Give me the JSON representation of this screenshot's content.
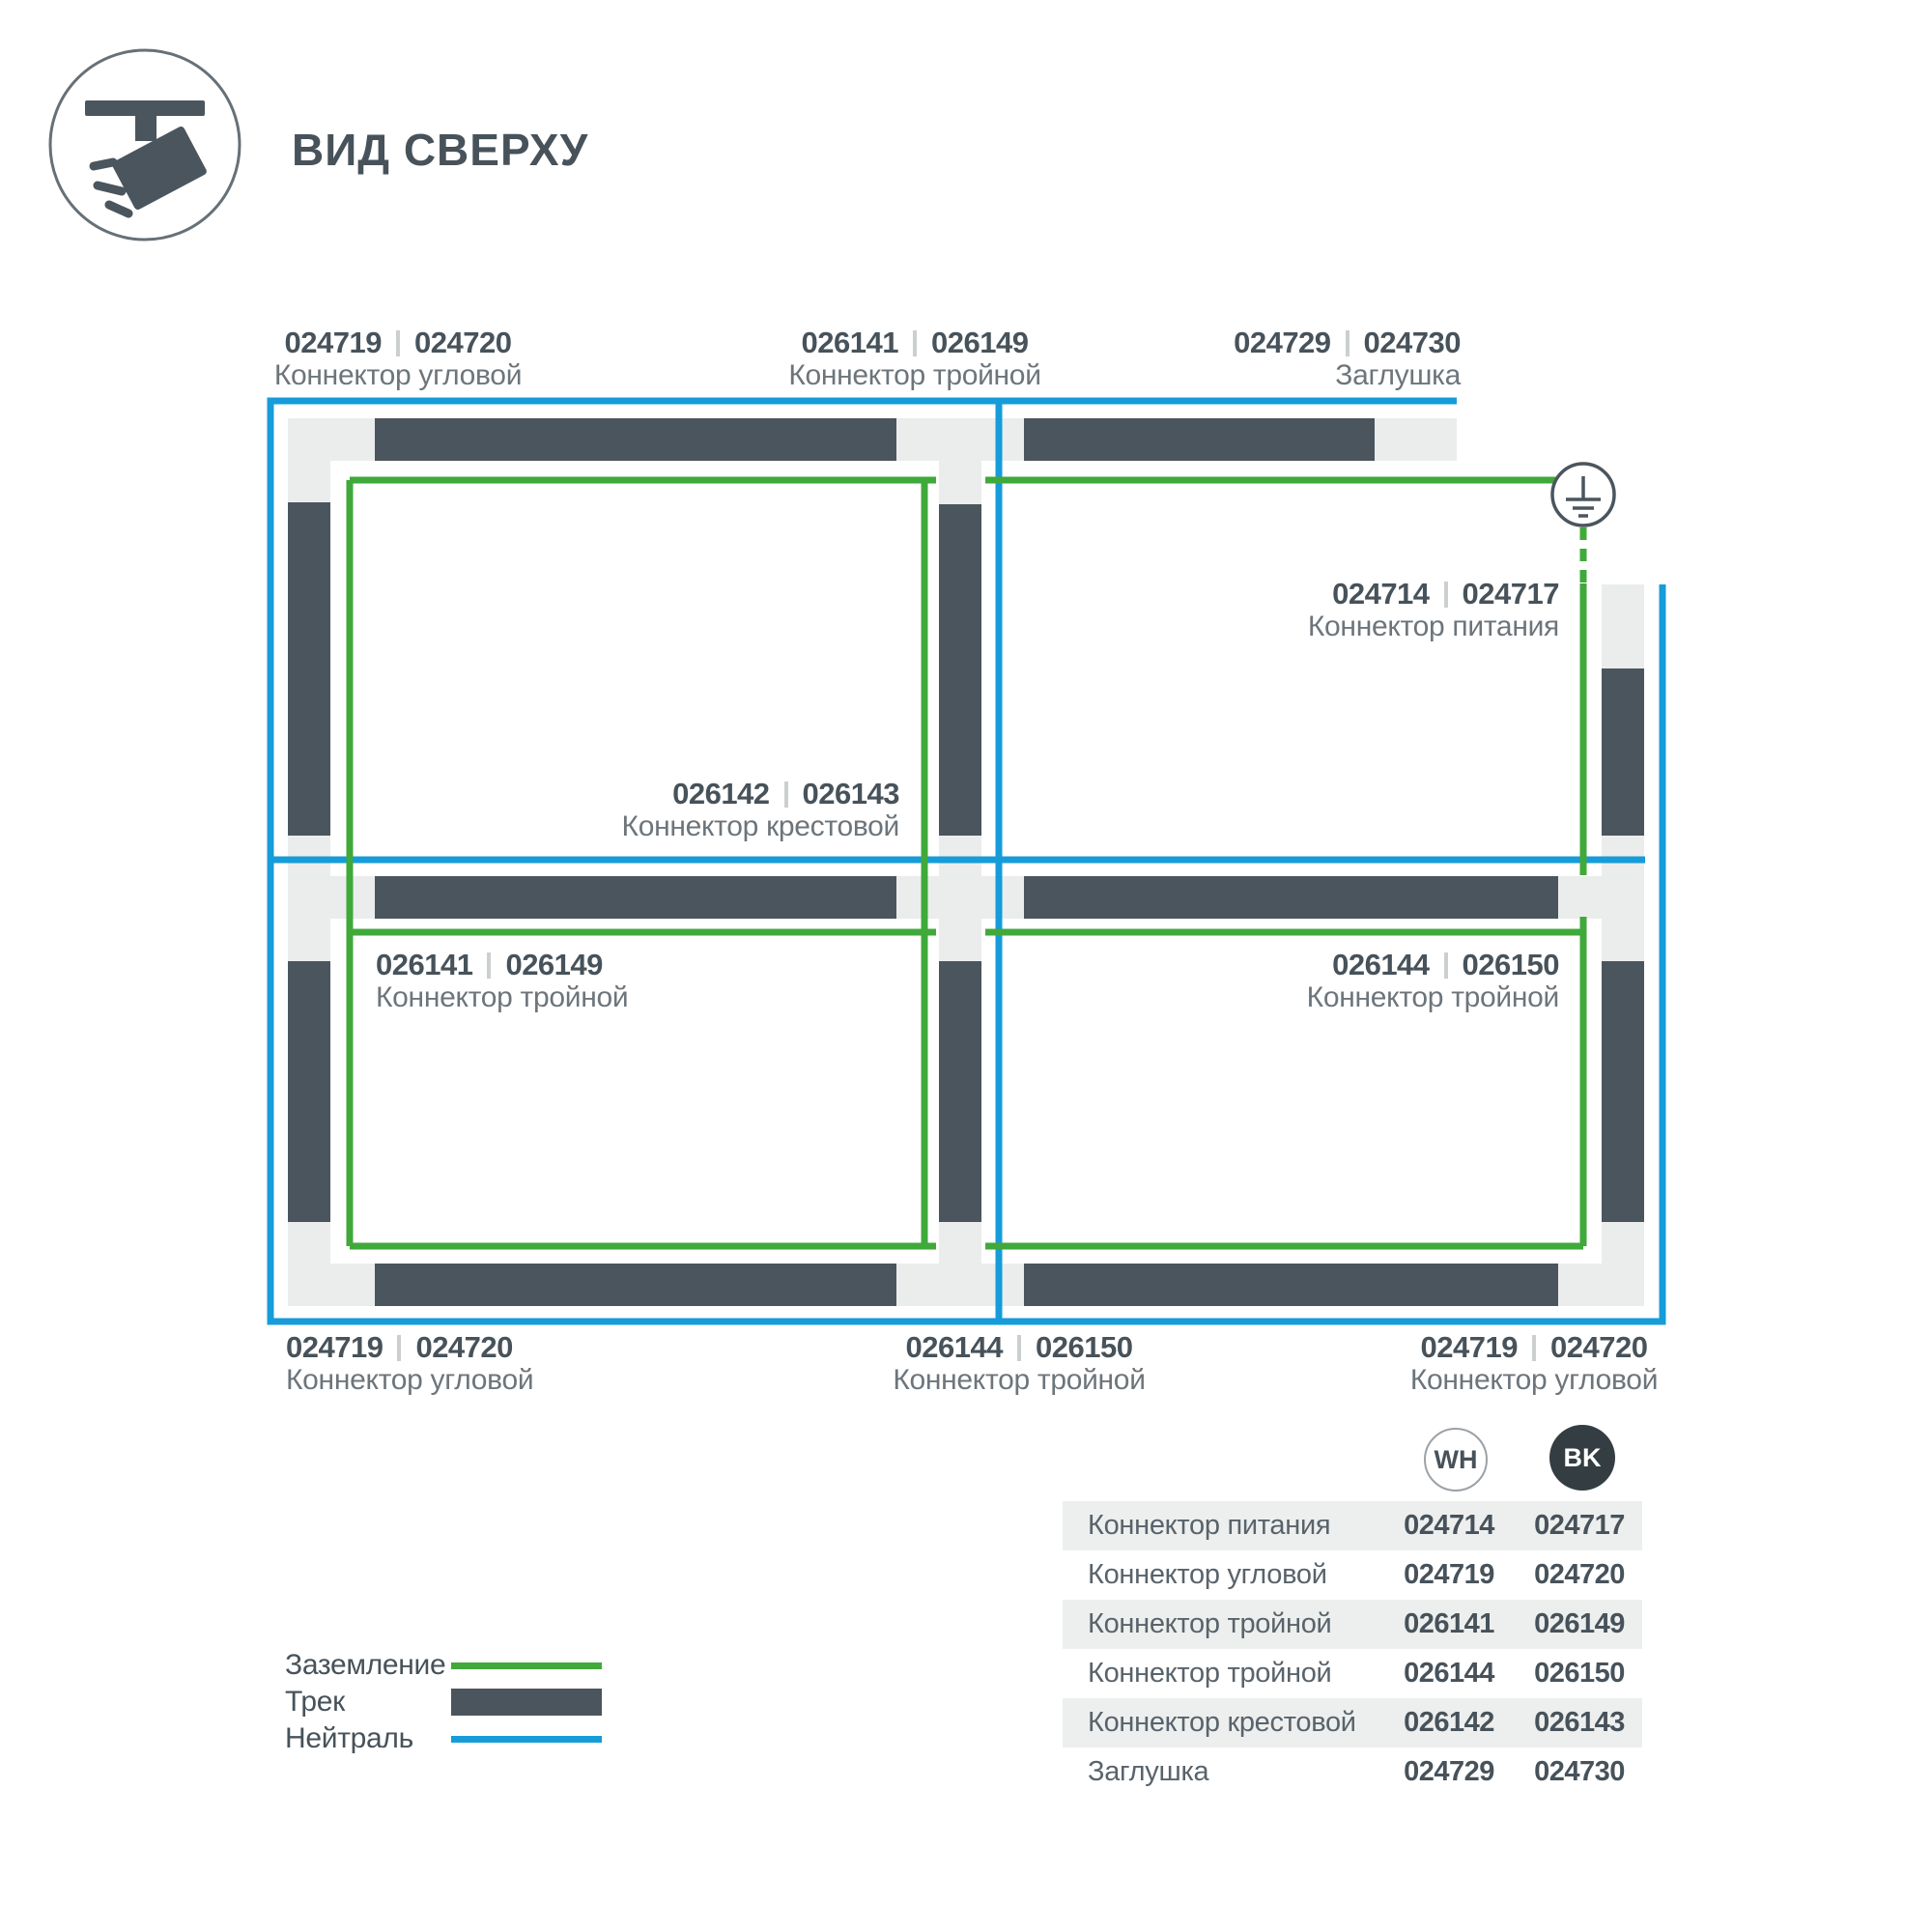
{
  "header": {
    "title": "ВИД СВЕРХУ",
    "icon": "track-spotlight-icon"
  },
  "diagram": {
    "ground_symbol": "earth-ground-icon",
    "labels": [
      {
        "codes": [
          "024719",
          "024720"
        ],
        "name": "Коннектор угловой"
      },
      {
        "codes": [
          "026141",
          "026149"
        ],
        "name": "Коннектор тройной"
      },
      {
        "codes": [
          "024729",
          "024730"
        ],
        "name": "Заглушка"
      },
      {
        "codes": [
          "024714",
          "024717"
        ],
        "name": "Коннектор питания"
      },
      {
        "codes": [
          "026142",
          "026143"
        ],
        "name": "Коннектор крестовой"
      },
      {
        "codes": [
          "026141",
          "026149"
        ],
        "name": "Коннектор тройной"
      },
      {
        "codes": [
          "026144",
          "026150"
        ],
        "name": "Коннектор тройной"
      },
      {
        "codes": [
          "024719",
          "024720"
        ],
        "name": "Коннектор угловой"
      },
      {
        "codes": [
          "026144",
          "026150"
        ],
        "name": "Коннектор тройной"
      },
      {
        "codes": [
          "024719",
          "024720"
        ],
        "name": "Коннектор угловой"
      }
    ]
  },
  "legend": {
    "items": [
      {
        "label": "Заземление",
        "swatch": "green-line"
      },
      {
        "label": "Трек",
        "swatch": "track-bar"
      },
      {
        "label": "Нейтраль",
        "swatch": "blue-line"
      }
    ]
  },
  "table": {
    "columns": [
      {
        "code": "WH"
      },
      {
        "code": "BK"
      }
    ],
    "rows": [
      {
        "name": "Коннектор питания",
        "wh": "024714",
        "bk": "024717"
      },
      {
        "name": "Коннектор угловой",
        "wh": "024719",
        "bk": "024720"
      },
      {
        "name": "Коннектор тройной",
        "wh": "026141",
        "bk": "026149"
      },
      {
        "name": "Коннектор тройной",
        "wh": "026144",
        "bk": "026150"
      },
      {
        "name": "Коннектор крестовой",
        "wh": "026142",
        "bk": "026143"
      },
      {
        "name": "Заглушка",
        "wh": "024729",
        "bk": "024730"
      }
    ]
  },
  "colors": {
    "track": "#4B555D",
    "connector": "#EBEDEC",
    "ground_green": "#3FA93A",
    "neutral_blue": "#169CD9",
    "text_dark": "#47525A",
    "text_gray": "#6D757B"
  }
}
